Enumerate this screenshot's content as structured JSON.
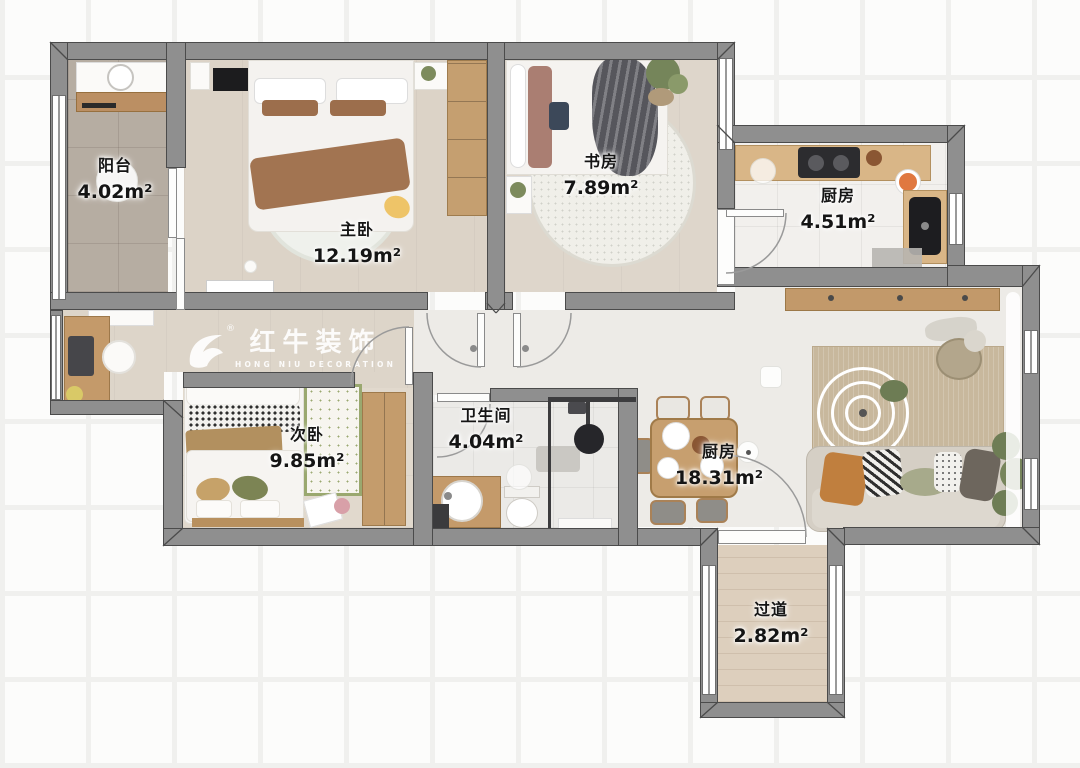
{
  "watermark": {
    "brand": "红牛装饰",
    "subtitle": "HONG NIU DECORATION",
    "registered": "®"
  },
  "rooms": [
    {
      "id": "balcony",
      "name": "阳台",
      "area": "4.02m²"
    },
    {
      "id": "master-bedroom",
      "name": "主卧",
      "area": "12.19m²"
    },
    {
      "id": "study",
      "name": "书房",
      "area": "7.89m²"
    },
    {
      "id": "kitchen",
      "name": "厨房",
      "area": "4.51m²"
    },
    {
      "id": "second-bedroom",
      "name": "次卧",
      "area": "9.85m²"
    },
    {
      "id": "bathroom",
      "name": "卫生间",
      "area": "4.04m²"
    },
    {
      "id": "living-dining",
      "name": "厨房",
      "area": "18.31m²"
    },
    {
      "id": "hallway",
      "name": "过道",
      "area": "2.82m²"
    }
  ],
  "colors": {
    "wall": "#8f8f8f",
    "wall_outline": "#4b4b4b",
    "wood": "#c49a6a",
    "floor_beige": "#ddd5c9",
    "accent_orange": "#c07f3e",
    "accent_green": "#7c8454"
  }
}
